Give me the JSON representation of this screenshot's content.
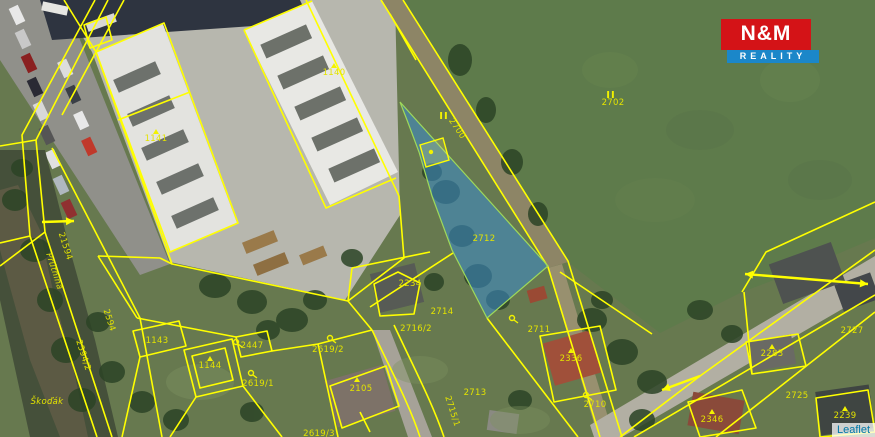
{
  "logo": {
    "line1": "N&M",
    "line2": "REALITY",
    "red": "#d41317",
    "blue": "#1b87c9"
  },
  "attribution": {
    "text": "Leaflet"
  },
  "map": {
    "line_color": "#ffff00",
    "label_color": "#e3e300",
    "highlight": {
      "parcel": "2712",
      "fill": "rgba(58,140,205,0.55)",
      "stroke": "#9ed95a"
    },
    "labels": [
      {
        "text": "1141",
        "x": 156,
        "y": 141
      },
      {
        "text": "1140",
        "x": 334,
        "y": 75
      },
      {
        "text": "2702",
        "x": 613,
        "y": 105
      },
      {
        "text": "2700",
        "x": 455,
        "y": 130,
        "rot": 56
      },
      {
        "text": "2712",
        "x": 484,
        "y": 241
      },
      {
        "text": "2234",
        "x": 410,
        "y": 286
      },
      {
        "text": "2714",
        "x": 442,
        "y": 314
      },
      {
        "text": "2716/2",
        "x": 416,
        "y": 331
      },
      {
        "text": "2711",
        "x": 539,
        "y": 332
      },
      {
        "text": "2619/2",
        "x": 328,
        "y": 352
      },
      {
        "text": "1143",
        "x": 157,
        "y": 343
      },
      {
        "text": "2447",
        "x": 252,
        "y": 348,
        "color": "#cf8a10"
      },
      {
        "text": "1144",
        "x": 210,
        "y": 368
      },
      {
        "text": "2619/1",
        "x": 258,
        "y": 386
      },
      {
        "text": "2105",
        "x": 361,
        "y": 391
      },
      {
        "text": "2619/3",
        "x": 319,
        "y": 436
      },
      {
        "text": "2713",
        "x": 475,
        "y": 395
      },
      {
        "text": "2715/1",
        "x": 450,
        "y": 412,
        "rot": 72
      },
      {
        "text": "2336",
        "x": 571,
        "y": 361
      },
      {
        "text": "2710",
        "x": 595,
        "y": 407
      },
      {
        "text": "2346",
        "x": 712,
        "y": 422
      },
      {
        "text": "2727",
        "x": 852,
        "y": 333
      },
      {
        "text": "2283",
        "x": 772,
        "y": 356
      },
      {
        "text": "2725",
        "x": 797,
        "y": 398
      },
      {
        "text": "2239",
        "x": 845,
        "y": 418
      },
      {
        "text": "21594",
        "x": 63,
        "y": 247,
        "rot": 72
      },
      {
        "text": "Prútnina",
        "x": 52,
        "y": 272,
        "rot": 72,
        "style": "italic"
      },
      {
        "text": "2594",
        "x": 107,
        "y": 321,
        "rot": 72
      },
      {
        "text": "2594/2",
        "x": 81,
        "y": 356,
        "rot": 72
      },
      {
        "text": "Škoďák",
        "x": 47,
        "y": 404,
        "style": "italic",
        "size": 11
      }
    ],
    "symbols": [
      {
        "type": "triangle",
        "x": 156,
        "y": 132
      },
      {
        "type": "triangle",
        "x": 334,
        "y": 66
      },
      {
        "type": "triangle",
        "x": 210,
        "y": 359
      },
      {
        "type": "triangle",
        "x": 571,
        "y": 351
      },
      {
        "type": "triangle",
        "x": 712,
        "y": 412
      },
      {
        "type": "triangle",
        "x": 772,
        "y": 347
      },
      {
        "type": "triangle",
        "x": 845,
        "y": 409
      },
      {
        "type": "triangle",
        "x": 357,
        "y": 380
      },
      {
        "type": "garden",
        "x": 330,
        "y": 338
      },
      {
        "type": "garden",
        "x": 251,
        "y": 373
      },
      {
        "type": "garden",
        "x": 512,
        "y": 318
      },
      {
        "type": "garden",
        "x": 586,
        "y": 395
      },
      {
        "type": "garden",
        "x": 236,
        "y": 342
      },
      {
        "type": "dot",
        "x": 431,
        "y": 152
      },
      {
        "type": "mark-ii",
        "x": 444,
        "y": 119
      },
      {
        "type": "mark-ii",
        "x": 611,
        "y": 98
      },
      {
        "type": "arrow",
        "x1": 42,
        "y1": 222,
        "x2": 74,
        "y2": 221
      },
      {
        "type": "arrow",
        "x1": 700,
        "y1": 376,
        "x2": 662,
        "y2": 390
      },
      {
        "type": "arrow",
        "x1": 745,
        "y1": 274,
        "x2": 868,
        "y2": 284,
        "double": true
      }
    ]
  }
}
